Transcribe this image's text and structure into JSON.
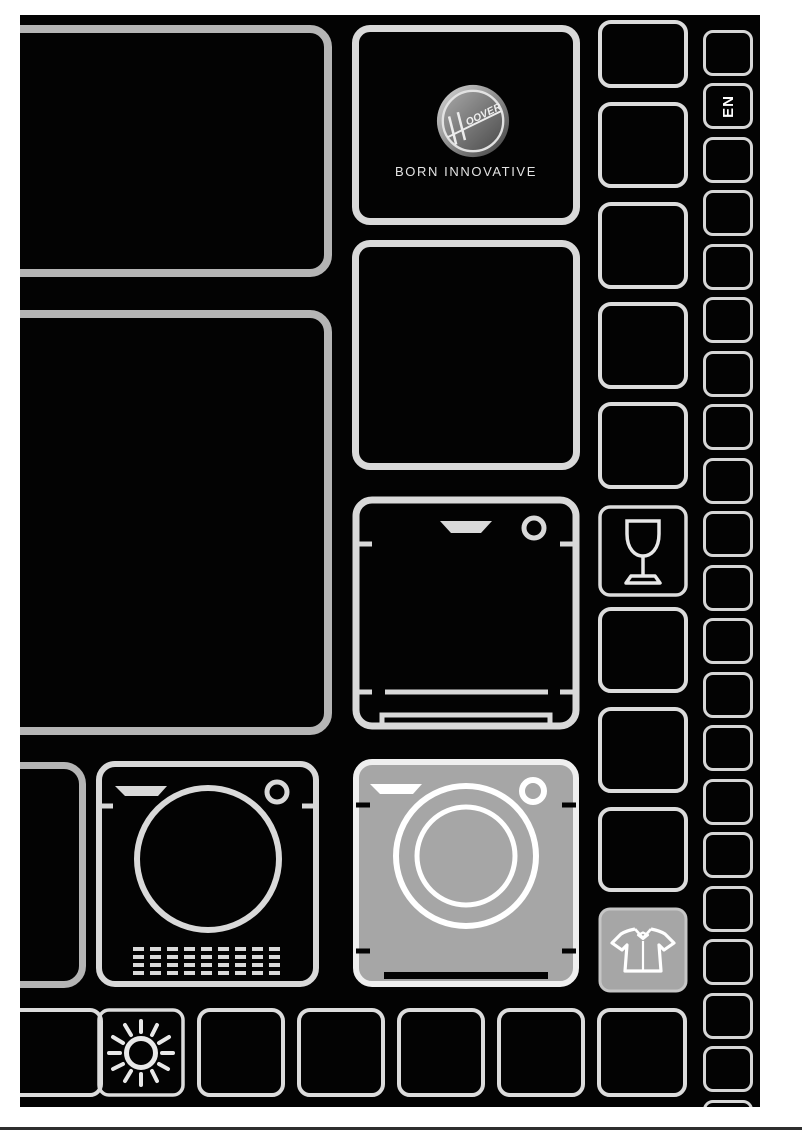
{
  "brand": {
    "name": "HOOVER",
    "logo_tail": "OOVER",
    "tagline": "BORN INNOVATIVE"
  },
  "language_tab": {
    "label": "EN"
  },
  "icons": {
    "hoover_logo": "hoover-logo",
    "wine_glass": "wine-glass-icon",
    "dishwasher": "dishwasher-icon",
    "tumble_dryer": "tumble-dryer-icon",
    "washing_machine": "washing-machine-icon",
    "shirt": "shirt-icon",
    "sun": "sun-icon"
  },
  "colors": {
    "cover_bg": "#030303",
    "outline": "#d9d9d9",
    "outline_dim": "#b5b5b5",
    "panel_gray": "#a6a6a6",
    "text_light": "#e3e3e3",
    "separator": "#2e2e2e"
  }
}
